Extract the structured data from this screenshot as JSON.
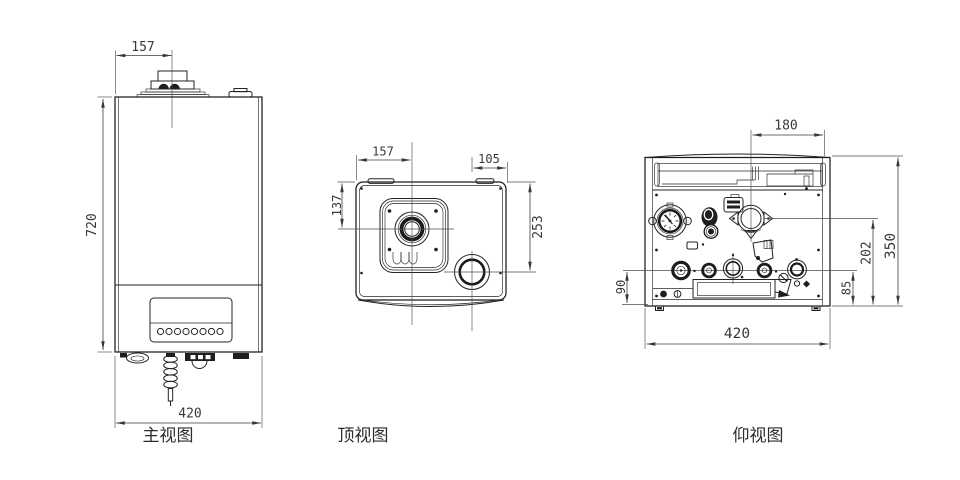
{
  "drawing": {
    "subject": "wall-hung boiler three-view engineering drawing",
    "background_color": "#ffffff",
    "line_color": "#232323",
    "dimension_text_color": "#383838",
    "views": {
      "front": {
        "label": "主视图",
        "dims": {
          "flue_offset_from_left": "157",
          "body_height": "720",
          "body_width": "420"
        }
      },
      "top": {
        "label": "顶视图",
        "dims": {
          "flue_offset_from_left": "157",
          "flue_offset_from_front": "137",
          "port_offset_from_right": "105",
          "port_offset_from_front": "253"
        }
      },
      "bottom": {
        "label": "仰视图",
        "dims": {
          "fan_offset_from_right": "180",
          "fan_center_to_bottom": "202",
          "body_depth": "350",
          "left_pipe_row_height": "90",
          "right_pipe_row_height": "85",
          "body_width": "420"
        }
      }
    }
  }
}
